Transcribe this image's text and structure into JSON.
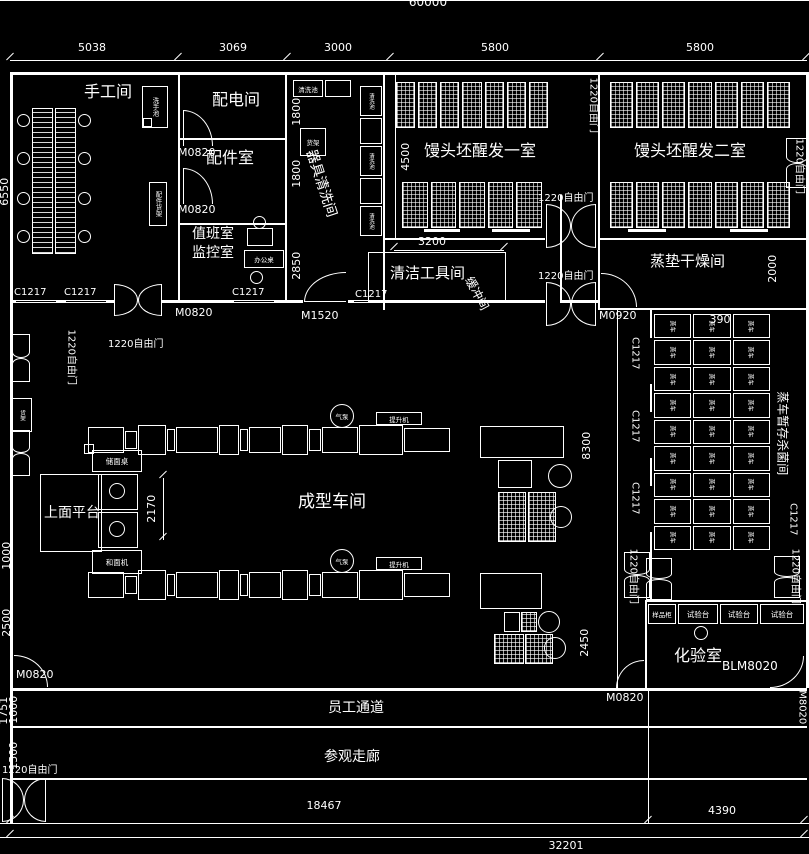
{
  "colors": {
    "background": "#000000",
    "line": "#ffffff",
    "text": "#ffffff"
  },
  "dims": {
    "total": "60000",
    "top": [
      "5038",
      "3069",
      "3000",
      "5800",
      "5800"
    ],
    "left": [
      "6550",
      "1000",
      "2500",
      "1751",
      "1000",
      "1500"
    ],
    "inner": [
      "1800",
      "1800",
      "2850",
      "4500",
      "3200",
      "2170",
      "390"
    ],
    "right": [
      "2000",
      "8300",
      "2450"
    ],
    "bottom": [
      "18467",
      "4390",
      "32201"
    ]
  },
  "rooms": {
    "shougong": "手工间",
    "peidian": "配电间",
    "peijian": "配件室",
    "zhiban": "值班室",
    "jiankong": "监控室",
    "qiju_qingxi": "器具清洗间",
    "qingjie_gongju": "清洁工具间",
    "xingfa1": "馒头坯醒发一室",
    "xingfa2": "馒头坯醒发二室",
    "zhengdian_ganzao": "蒸垫干燥间",
    "zhengche_zancun": "蒸车暂存杀菌间",
    "chengxing": "成型车间",
    "huanchong": "缓冲间",
    "huayan": "化验室",
    "pingtai": "上面平台",
    "yuangong_tongdao": "员工通道",
    "canguan_zoulang": "参观走廊"
  },
  "doors": {
    "m0820": "M0820",
    "m1520": "M1520",
    "m0920": "M0920",
    "blm8020": "BLM8020",
    "m8020": "M8020",
    "free1220": "1220自由门"
  },
  "windows": {
    "c1217": "C1217"
  },
  "equipment": {
    "zhengche": "蒸车",
    "qingxichi": "清洗池",
    "xishouchi": "洗手池",
    "huojia": "货架",
    "peijian_huojia": "配件货架",
    "bangongzhuo": "办公桌",
    "yangpin_gui": "样品柜",
    "shiyantai": "试验台",
    "hemianji": "和面机",
    "chumianzhuo": "储面桌",
    "qibeng": "气泵",
    "tishengji": "提升机"
  }
}
